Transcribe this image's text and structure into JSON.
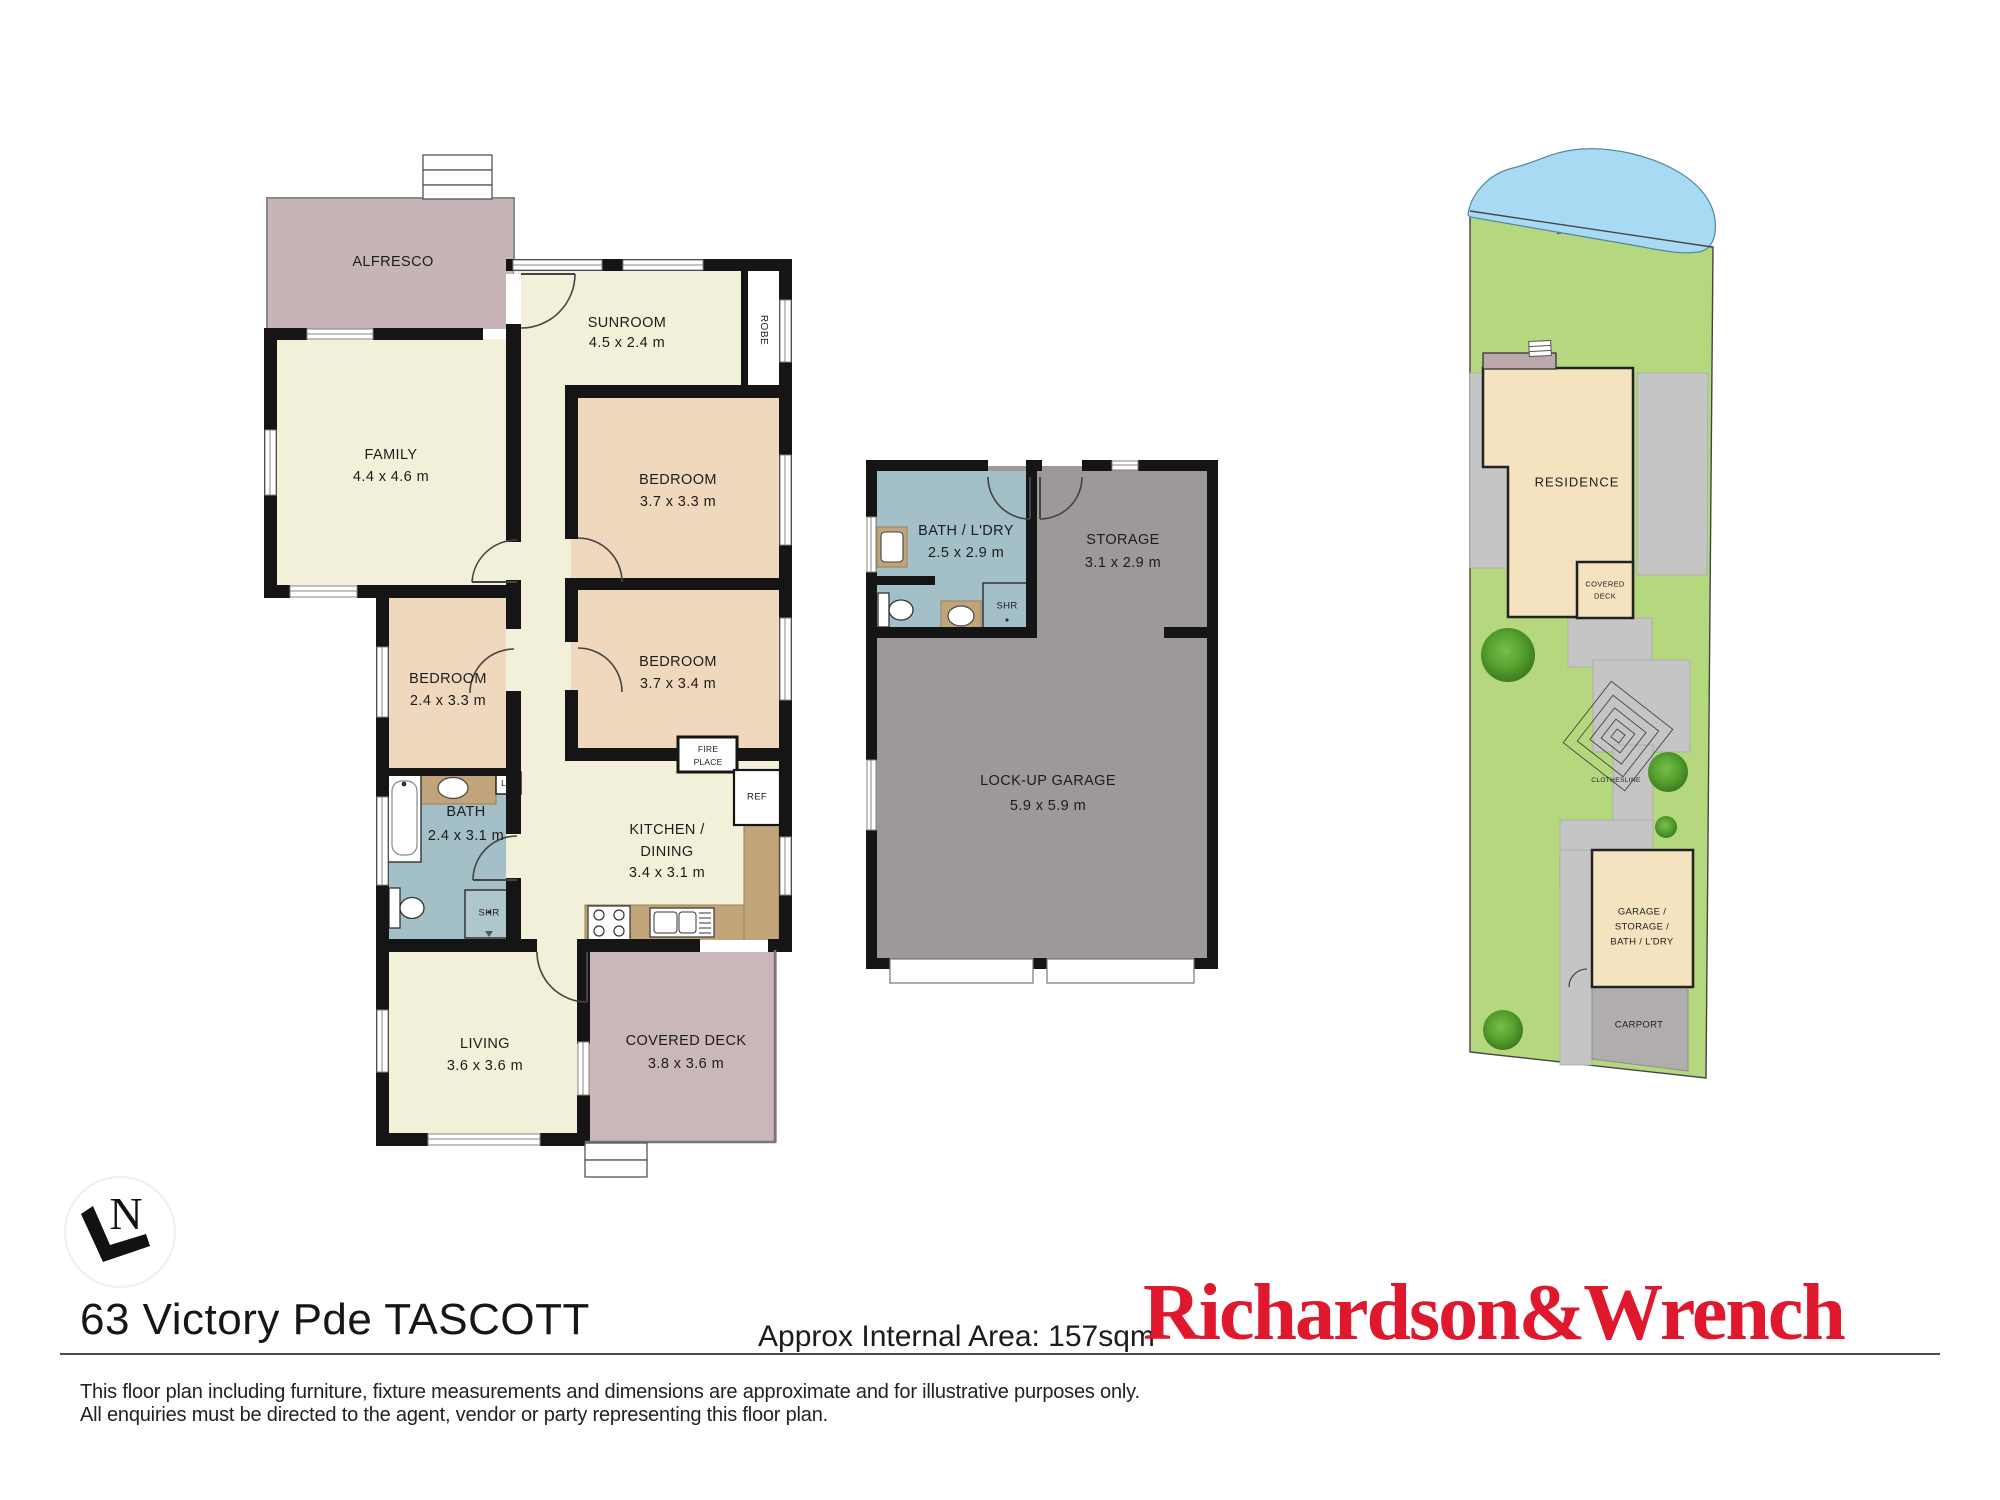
{
  "plan": {
    "alfresco": "ALFRESCO",
    "sunroom": "SUNROOM",
    "sunroom_dims": "4.5 x 2.4 m",
    "robe": "ROBE",
    "family": "FAMILY",
    "family_dims": "4.4 x 4.6 m",
    "bed1": "BEDROOM",
    "bed1_dims": "3.7 x 3.3 m",
    "bed2": "BEDROOM",
    "bed2_dims": "3.7 x 3.4 m",
    "bed3": "BEDROOM",
    "bed3_dims": "2.4 x 3.3 m",
    "bath": "BATH",
    "bath_dims": "2.4 x 3.1 m",
    "kitchen_line1": "KITCHEN /",
    "kitchen_line2": "DINING",
    "kitchen_dims": "3.4 x 3.1 m",
    "living": "LIVING",
    "living_dims": "3.6 x 3.6 m",
    "deck": "COVERED DECK",
    "deck_dims": "3.8 x 3.6 m",
    "lin": "LIN",
    "shr": "SHR",
    "ref": "REF",
    "fire_line1": "FIRE",
    "fire_line2": "PLACE"
  },
  "outbuilding": {
    "bath": "BATH / L'DRY",
    "bath_dims": "2.5 x 2.9 m",
    "storage": "STORAGE",
    "storage_dims": "3.1 x 2.9 m",
    "shr": "SHR",
    "garage": "LOCK-UP GARAGE",
    "garage_dims": "5.9 x 5.9 m"
  },
  "site": {
    "residence": "RESIDENCE",
    "deck_line1": "COVERED",
    "deck_line2": "DECK",
    "garage_line1": "GARAGE /",
    "garage_line2": "STORAGE /",
    "garage_line3": "BATH / L'DRY",
    "carport": "CARPORT",
    "clothesline": "CLOTHESLINE"
  },
  "footer": {
    "north": "N",
    "address": "63 Victory Pde TASCOTT",
    "area": "Approx Internal Area: 157sqm",
    "brand": "Richardson&Wrench",
    "disclaimer1": "This floor plan including furniture, fixture measurements and dimensions are approximate and for illustrative purposes only.",
    "disclaimer2": "All enquiries must be directed to the agent, vendor or party representing this floor plan."
  },
  "colors": {
    "room_cream": "#F3F0D9",
    "bedroom_peach": "#F0D8BE",
    "alfresco_mauve": "#C6B4B6",
    "deck_mauve": "#C9B7B9",
    "bath_blue": "#A3BFC7",
    "garage_gray": "#9D989A",
    "counter_brown": "#C2A47B",
    "site_green": "#B5D87E",
    "water_blue": "#A9DAF3",
    "path_gray": "#C6C5C5",
    "carport_gray": "#B1ADAE",
    "site_building": "#F4E3BE",
    "wall_black": "#151515",
    "brand_red": "#E0182D"
  }
}
